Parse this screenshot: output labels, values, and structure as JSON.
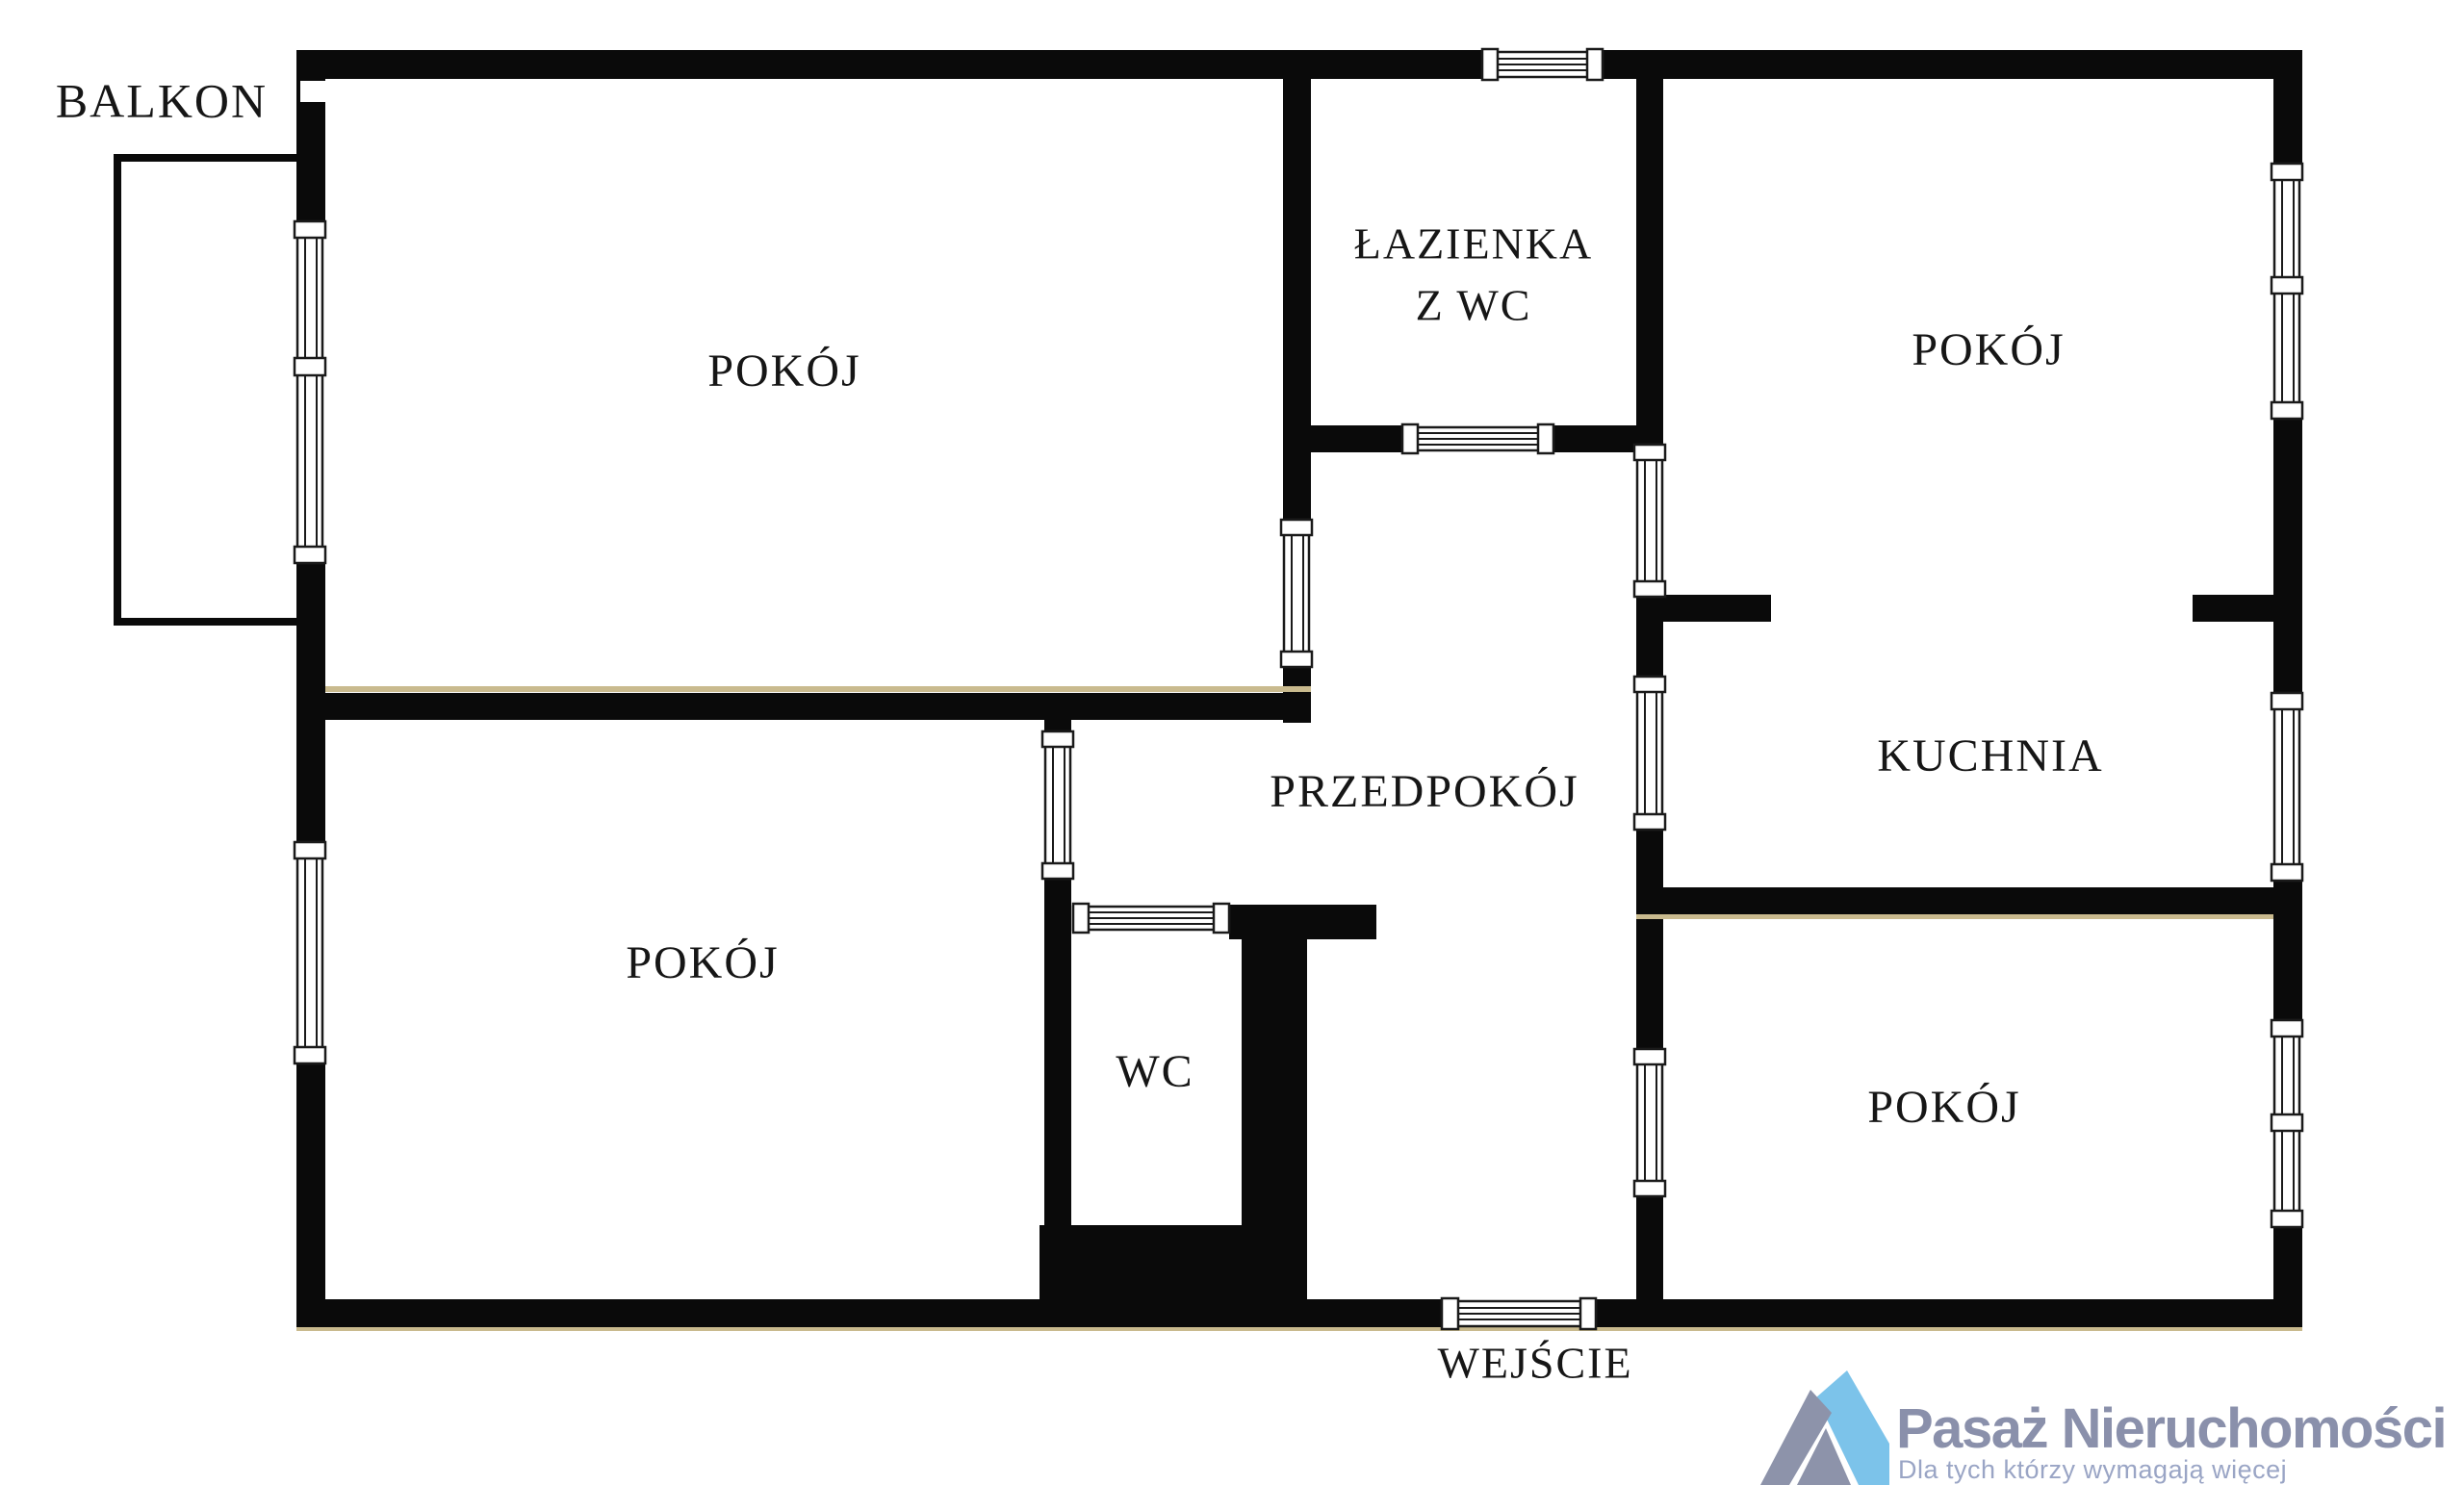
{
  "plan": {
    "rooms": {
      "balkon": {
        "label": "BALKON"
      },
      "pokoj_tl": {
        "label": "POKÓJ"
      },
      "lazienka": {
        "line1": "ŁAZIENKA",
        "line2": "Z WC"
      },
      "pokoj_tr": {
        "label": "POKÓJ"
      },
      "przedpokoj": {
        "label": "PRZEDPOKÓJ"
      },
      "kuchnia": {
        "label": "KUCHNIA"
      },
      "pokoj_bl": {
        "label": "POKÓJ"
      },
      "wc": {
        "label": "WC"
      },
      "pokoj_br": {
        "label": "POKÓJ"
      },
      "entrance": {
        "label": "WEJŚCIE"
      }
    },
    "colors": {
      "wall": "#0a0a0a",
      "label": "#161616",
      "accent": "#c9ba8e",
      "background": "#ffffff"
    }
  },
  "branding": {
    "name": "Pasaż Nieruchomości",
    "tagline": "Dla tych którzy wymagają więcej",
    "colors": {
      "title": "#8a90ab",
      "tagline": "#9aa5c5",
      "mark_gray": "#8d93aa",
      "mark_blue": "#7cc3ea"
    }
  }
}
